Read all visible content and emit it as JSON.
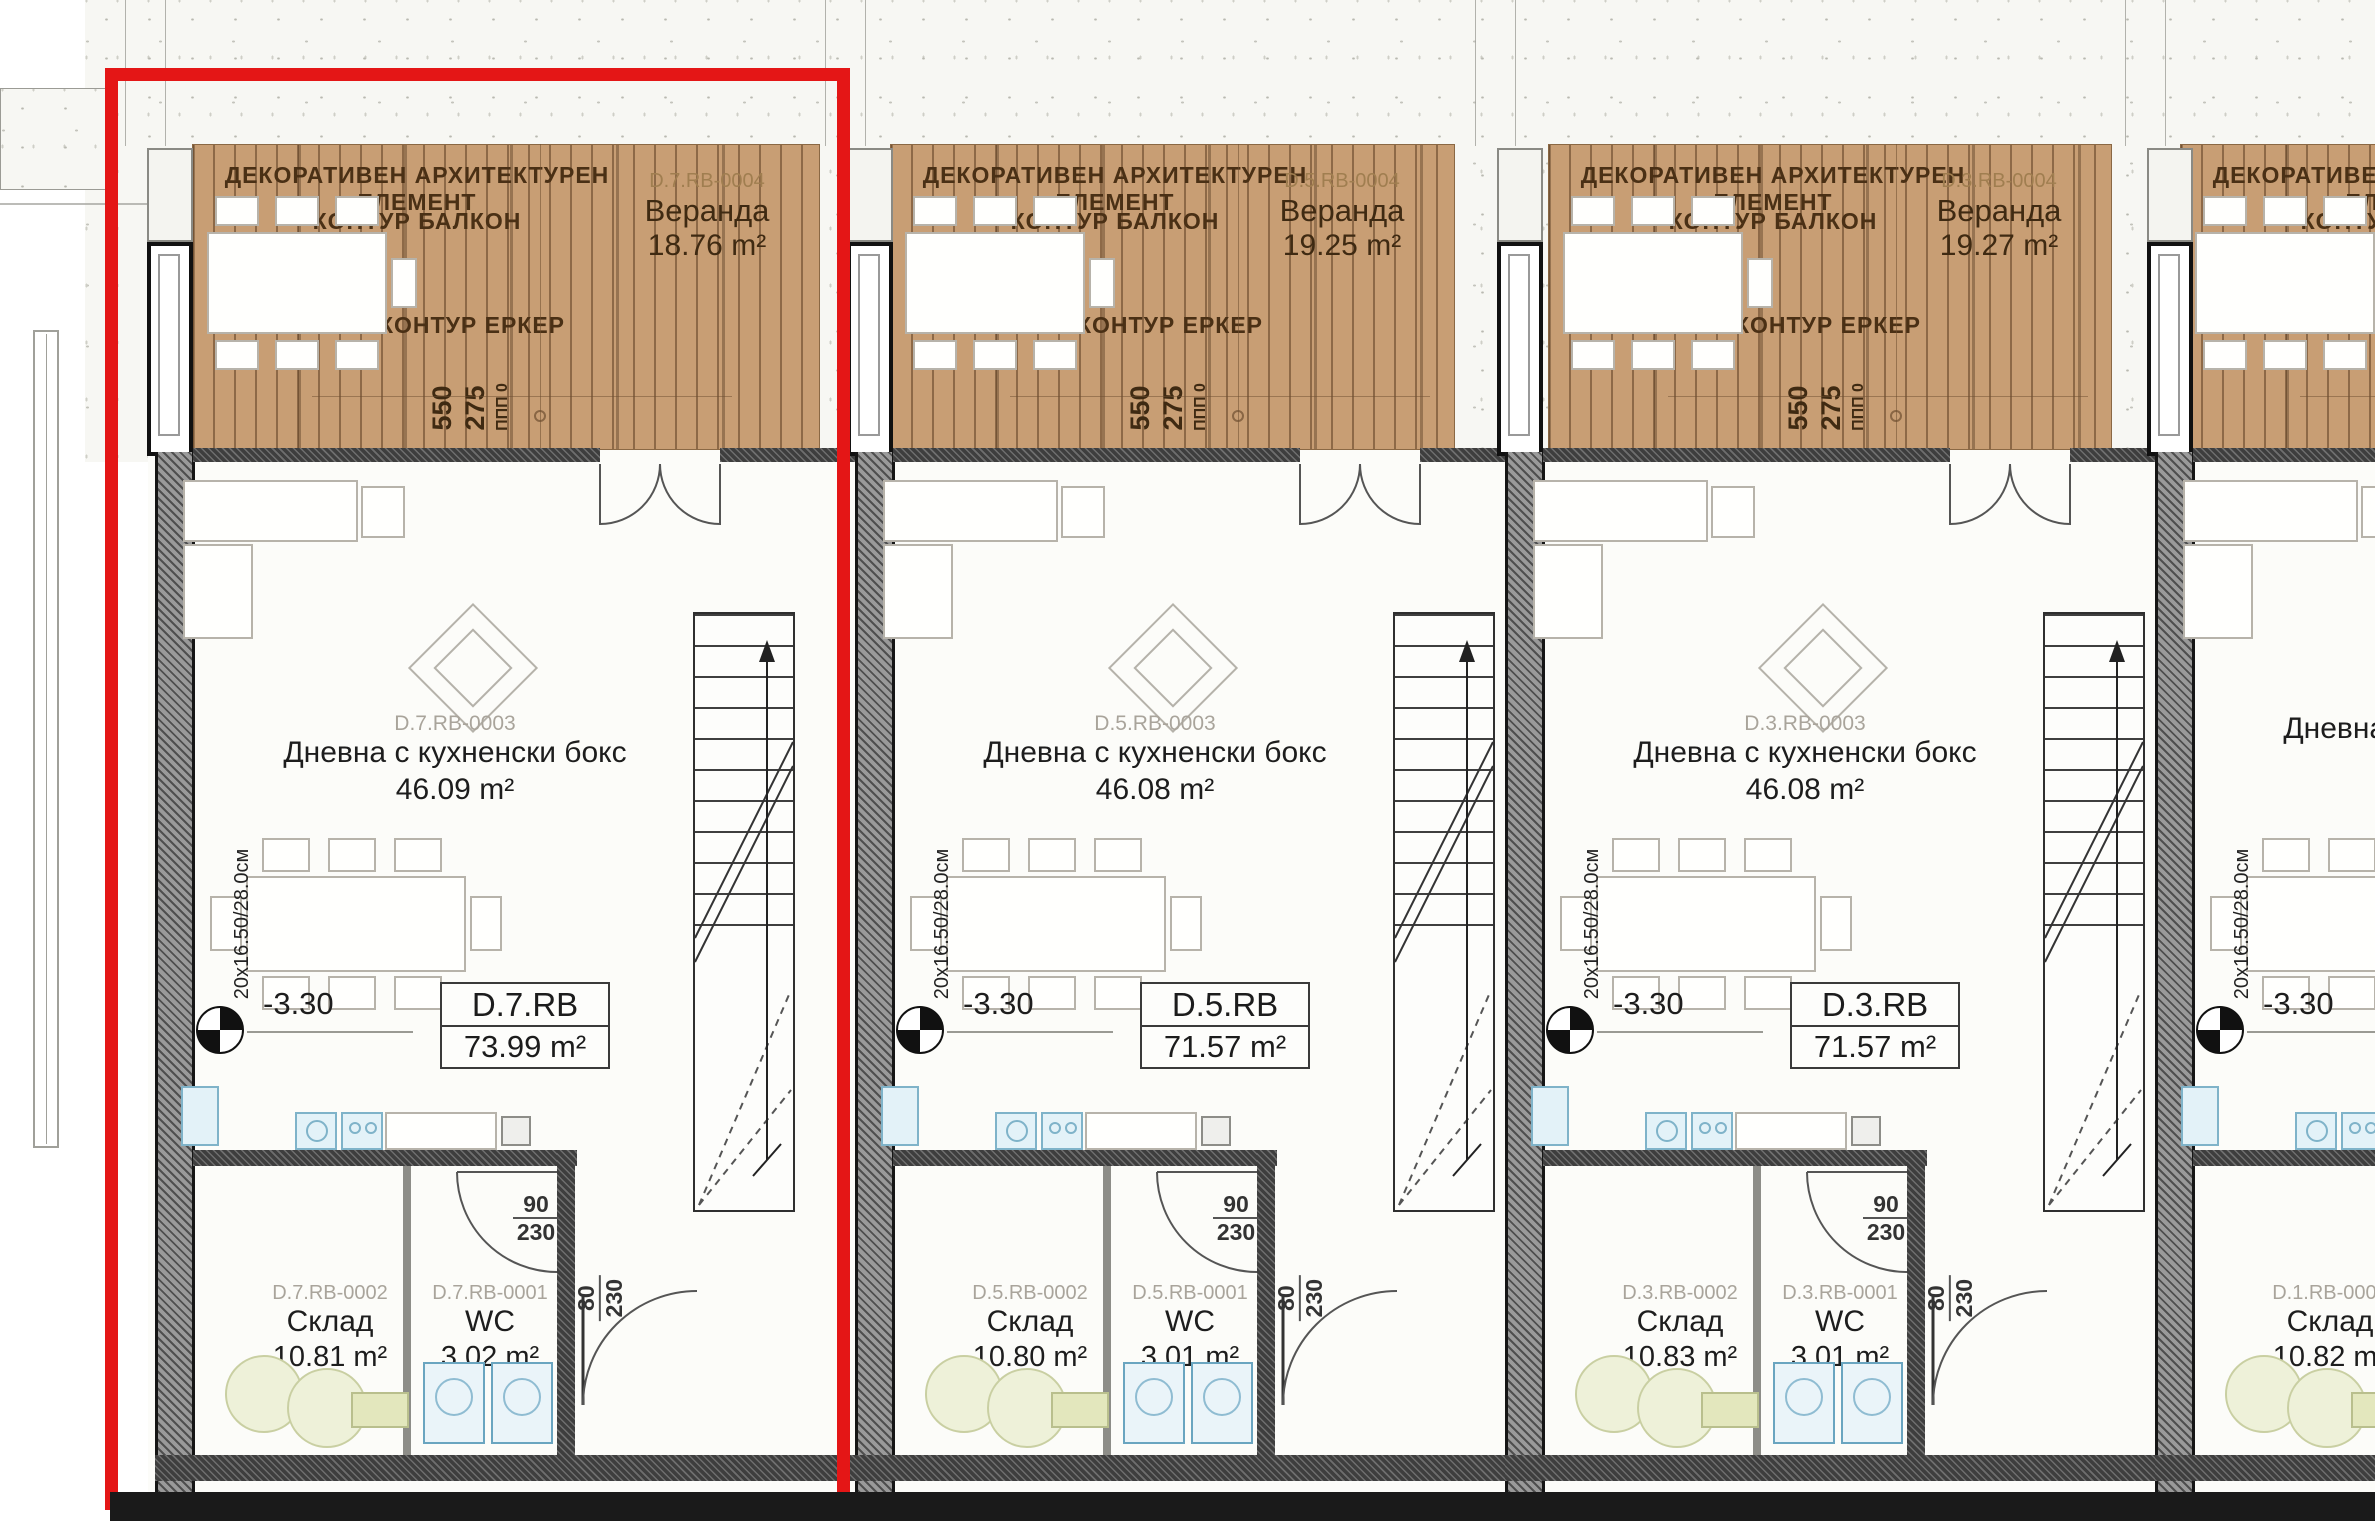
{
  "common": {
    "deco_label": "ДЕКОРАТИВЕН АРХИТЕКТУРЕН ЕЛЕМЕНТ",
    "balkon_label": "КОНТУР БАЛКОН",
    "erker_label": "КОНТУР ЕРКЕР",
    "veranda_word": "Веранда",
    "dim_550": "550",
    "dim_275": "275",
    "dim_ppp": "ППП 0",
    "stairs_label": "20x16.50/28.0см",
    "level_value": "-3.30",
    "living_name": "Дневна с кухненски бокс",
    "storage_name": "Склад",
    "wc_name": "WC",
    "door_main_top": "90",
    "door_main_bottom": "230",
    "door_wc_top": "80",
    "door_wc_bottom": "230"
  },
  "units": [
    {
      "code": "D.7.RB",
      "total_area": "73.99 m²",
      "veranda_id": "D.7.RB-0004",
      "veranda_area": "18.76 m²",
      "living_id": "D.7.RB-0003",
      "living_area": "46.09 m²",
      "storage_id": "D.7.RB-0002",
      "storage_area": "10.81 m²",
      "wc_id": "D.7.RB-0001",
      "wc_area": "3.02 m²"
    },
    {
      "code": "D.5.RB",
      "total_area": "71.57 m²",
      "veranda_id": "D.5.RB-0004",
      "veranda_area": "19.25 m²",
      "living_id": "D.5.RB-0003",
      "living_area": "46.08 m²",
      "storage_id": "D.5.RB-0002",
      "storage_area": "10.80 m²",
      "wc_id": "D.5.RB-0001",
      "wc_area": "3.01 m²"
    },
    {
      "code": "D.3.RB",
      "total_area": "71.57 m²",
      "veranda_id": "D.3.RB-0004",
      "veranda_area": "19.27 m²",
      "living_id": "D.3.RB-0003",
      "living_area": "46.08 m²",
      "storage_id": "D.3.RB-0002",
      "storage_area": "10.83 m²",
      "wc_id": "D.3.RB-0001",
      "wc_area": "3.01 m²"
    },
    {
      "code": "",
      "total_area": "",
      "veranda_id": "",
      "veranda_area": "",
      "living_id": "",
      "living_area": "",
      "storage_id": "D.1.RB-0002",
      "storage_area": "10.82 m²",
      "wc_id": "",
      "wc_area": ""
    }
  ]
}
